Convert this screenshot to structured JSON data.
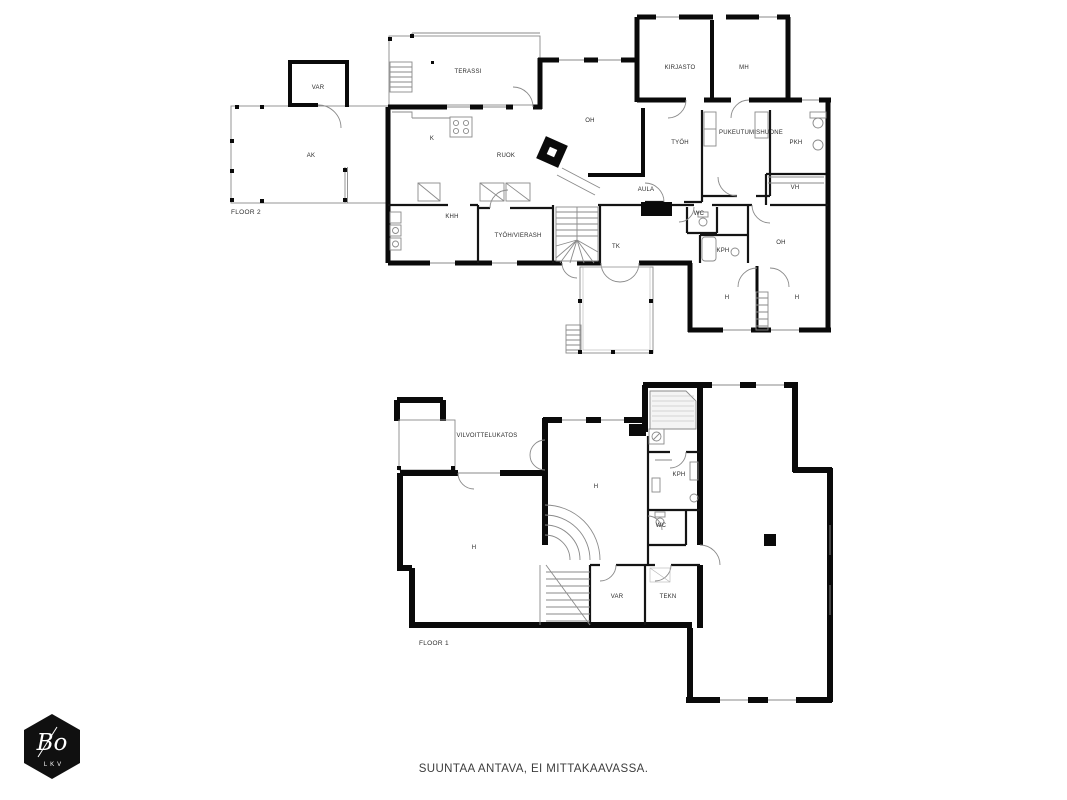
{
  "caption": "SUUNTAA ANTAVA, EI MITTAKAAVASSA.",
  "logo": {
    "brand": "Bo",
    "sub": "LKV"
  },
  "floors": [
    {
      "id": "floor2",
      "label": "FLOOR 2",
      "rooms": [
        {
          "id": "var2",
          "label": "VAR"
        },
        {
          "id": "terassi",
          "label": "TERASSI"
        },
        {
          "id": "ak",
          "label": "AK"
        },
        {
          "id": "k",
          "label": "K"
        },
        {
          "id": "ruok",
          "label": "RUOK"
        },
        {
          "id": "oh",
          "label": "OH"
        },
        {
          "id": "kirjasto",
          "label": "KIRJASTO"
        },
        {
          "id": "mh",
          "label": "MH"
        },
        {
          "id": "tyoh",
          "label": "TYÖH"
        },
        {
          "id": "pukeutumishuone",
          "label": "PUKEUTUMISHUONE"
        },
        {
          "id": "pkh",
          "label": "PKH"
        },
        {
          "id": "aula",
          "label": "AULA"
        },
        {
          "id": "vh",
          "label": "VH"
        },
        {
          "id": "khh",
          "label": "KHH"
        },
        {
          "id": "tyoh-vierash",
          "label": "TYÖH/VIERASH"
        },
        {
          "id": "tk",
          "label": "TK"
        },
        {
          "id": "wc2",
          "label": "WC"
        },
        {
          "id": "kph2",
          "label": "KPH"
        },
        {
          "id": "oh2",
          "label": "OH"
        },
        {
          "id": "h2a",
          "label": "H"
        },
        {
          "id": "h2b",
          "label": "H"
        }
      ]
    },
    {
      "id": "floor1",
      "label": "FLOOR 1",
      "rooms": [
        {
          "id": "vilvoittelukatos",
          "label": "VILVOITTELUKATOS"
        },
        {
          "id": "h1-center",
          "label": "H"
        },
        {
          "id": "kph1",
          "label": "KPH"
        },
        {
          "id": "wc1",
          "label": "WC"
        },
        {
          "id": "h1-left",
          "label": "H"
        },
        {
          "id": "var1",
          "label": "VAR"
        },
        {
          "id": "tekn",
          "label": "TEKN"
        }
      ]
    }
  ]
}
